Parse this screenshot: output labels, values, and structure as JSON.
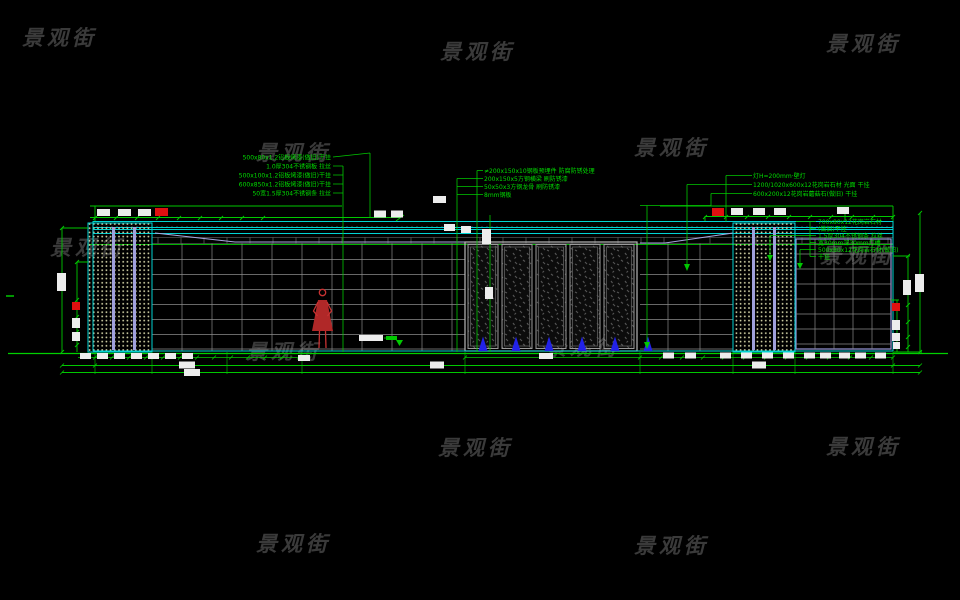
{
  "watermark": {
    "text": "景观街"
  },
  "annotations": {
    "left": [
      "500x80x1.2铝板烤漆(做旧)干挂",
      "1.0厚304不锈钢板 拉丝",
      "500x100x1.2铝板烤漆(做旧)干挂",
      "600x850x1.2铝板烤漆(做旧)干挂",
      "50宽1.5厚304不锈钢条 拉丝"
    ],
    "middle": [
      "≠200x150x10钢板预埋件 防腐防锈处理",
      "200x150x5方钢横梁 刷防锈漆",
      "50x50x3方钢龙骨 刷防锈漆",
      "8mm钢板"
    ],
    "right": [
      "灯H=200mm·壁灯",
      "1200/1020x600x12花岗岩石材 光面 干挂",
      "600x200x12花岗岩蘑菇石(做旧) 干挂"
    ],
    "right_lower": [
      "700x80x12花岗岩石材",
      "(做旧)干挂",
      "1.5厚304不锈钢条 拉丝",
      "宽30mm深30mm灯槽",
      "500x80x12花岗岩石材(做旧)",
      "干挂"
    ]
  },
  "colors": {
    "background": "#000000",
    "dimension_green": "#00c800",
    "cyan_outline": "#00d2d2",
    "grid_gray": "#8a8a8a",
    "purple_accent": "#a0a0dc",
    "red_highlight": "#e01010",
    "blue_symbol": "#2222e8",
    "figure_red": "#c83232",
    "watermark_gray": "#3a3a3a",
    "annotation_text": "#00dc00"
  }
}
